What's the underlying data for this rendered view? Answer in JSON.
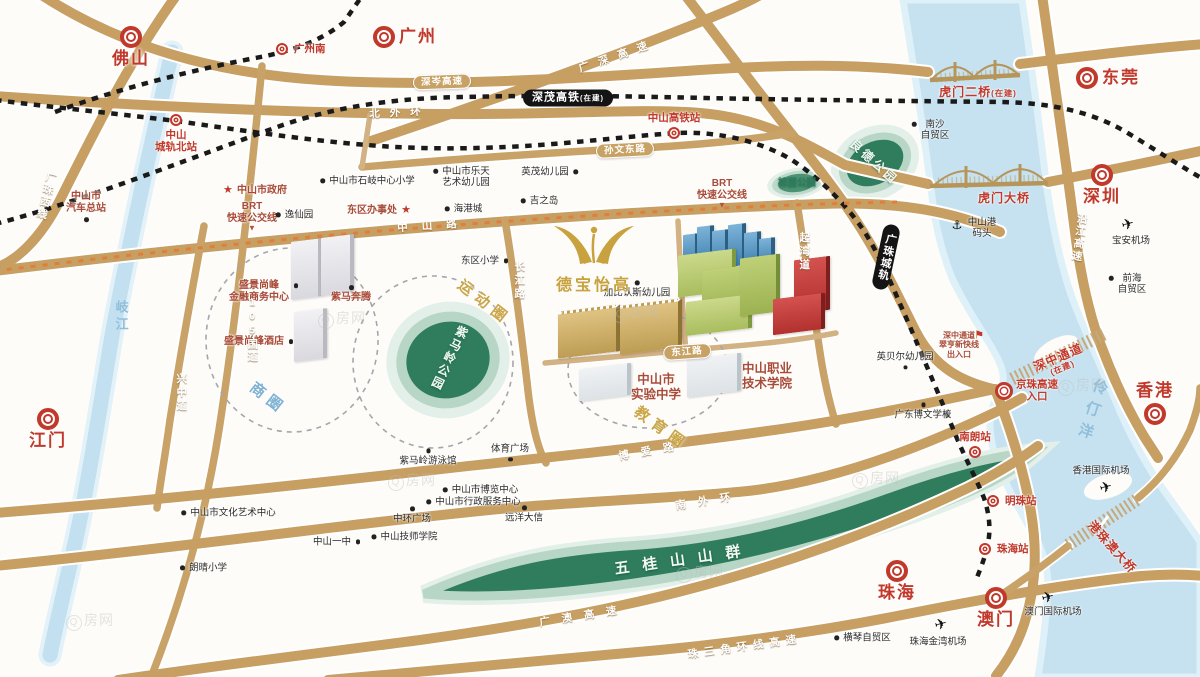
{
  "meta": {
    "watermark": "Q房网"
  },
  "brand": {
    "name": "德宝怡高"
  },
  "colors": {
    "accent_red": "#c0392b",
    "poi_red": "#a84b38",
    "road_tan": "#c79f63",
    "rail_black": "#1a1a1a",
    "park_green": "#2f7d5c",
    "water_blue": "#c6e2f0",
    "gold": "#c8a23e",
    "brt_orange": "#e07f3a"
  },
  "features": [
    {
      "t": "city",
      "name": "city-foshan",
      "text": "佛山",
      "x": 131,
      "y": 37,
      "lp": "b"
    },
    {
      "t": "city",
      "name": "city-guangzhou",
      "text": "广州",
      "x": 384,
      "y": 37,
      "lp": "r"
    },
    {
      "t": "city",
      "name": "city-dongguan",
      "text": "东莞",
      "x": 1087,
      "y": 78,
      "lp": "r"
    },
    {
      "t": "city",
      "name": "city-shenzhen",
      "text": "深圳",
      "x": 1102,
      "y": 175,
      "lp": "b"
    },
    {
      "t": "city",
      "name": "city-hongkong",
      "text": "香港",
      "x": 1155,
      "y": 414,
      "lp": "a"
    },
    {
      "t": "city",
      "name": "city-jiangmen",
      "text": "江门",
      "x": 48,
      "y": 419,
      "lp": "b"
    },
    {
      "t": "city",
      "name": "city-zhuhai",
      "text": "珠海",
      "x": 897,
      "y": 571,
      "lp": "b"
    },
    {
      "t": "city",
      "name": "city-macau",
      "text": "澳门",
      "x": 996,
      "y": 598,
      "lp": "b"
    },
    {
      "t": "sta",
      "name": "station-guangzhounan",
      "text": "广州南",
      "x": 282,
      "y": 49,
      "lp": "r"
    },
    {
      "t": "sta",
      "name": "station-zhongshanbei",
      "lines": [
        "中山",
        "城轨北站"
      ],
      "x": 176,
      "y": 120,
      "lp": "b"
    },
    {
      "t": "sta",
      "name": "station-zhongshan-hsr",
      "text": "中山高铁站",
      "x": 674,
      "y": 133,
      "lp": "a",
      "size": 12
    },
    {
      "t": "sta",
      "name": "station-nanlang",
      "text": "南朗站",
      "x": 975,
      "y": 452,
      "lp": "a"
    },
    {
      "t": "sta",
      "name": "station-mingzhu",
      "text": "明珠站",
      "x": 993,
      "y": 501,
      "lp": "r"
    },
    {
      "t": "sta",
      "name": "station-zhuhai",
      "text": "珠海站",
      "x": 985,
      "y": 549,
      "lp": "r"
    },
    {
      "t": "sta",
      "name": "jingzhu-expressway-entrance",
      "lines": [
        "京珠高速",
        "入口"
      ],
      "x": 1004,
      "y": 391,
      "lp": "r",
      "size": 12,
      "cls": "big"
    },
    {
      "t": "poir",
      "name": "poi-city-hall",
      "text": "中山市政府",
      "x": 262,
      "y": 191,
      "star": "l"
    },
    {
      "t": "poir",
      "name": "poi-dongqu-office",
      "text": "东区办事处",
      "x": 372,
      "y": 211,
      "star": "r"
    },
    {
      "t": "poir",
      "name": "brt-label-west",
      "lines": [
        "BRT",
        "快速公交线"
      ],
      "x": 252,
      "y": 213
    },
    {
      "t": "poir",
      "name": "brt-label-east",
      "lines": [
        "BRT",
        "快速公交线"
      ],
      "x": 722,
      "y": 190
    },
    {
      "t": "poir",
      "name": "poi-bus-terminal",
      "lines": [
        "中山市",
        "汽车总站"
      ],
      "x": 86,
      "y": 203,
      "dot": "b"
    },
    {
      "t": "poir",
      "name": "poi-shengjing-center",
      "lines": [
        "盛景尚峰",
        "金融商务中心"
      ],
      "x": 259,
      "y": 292,
      "dot": "r"
    },
    {
      "t": "poir",
      "name": "poi-shengjing-hotel",
      "text": "盛景尚峰酒店",
      "x": 254,
      "y": 342,
      "dot": "r"
    },
    {
      "t": "poir",
      "name": "poi-zima-benteng",
      "text": "紫马奔腾",
      "x": 351,
      "y": 298,
      "dot": "a"
    },
    {
      "t": "poir",
      "name": "poi-experimental-school",
      "lines": [
        "中山市",
        "实验中学"
      ],
      "x": 656,
      "y": 387,
      "size": 12.5
    },
    {
      "t": "poir",
      "name": "poi-polytechnic",
      "lines": [
        "中山职业",
        "技术学院"
      ],
      "x": 767,
      "y": 376,
      "size": 12.5
    },
    {
      "t": "poir",
      "name": "shenzhong-entrance-note",
      "lines": [
        "深中通道",
        "翠亨新快线",
        "出入口"
      ],
      "x": 959,
      "y": 345,
      "size": 8
    },
    {
      "t": "br",
      "name": "bridge-humen2-label",
      "text": "虎门二桥",
      "sub": "(在建)",
      "x": 978,
      "y": 92,
      "cls": "inl"
    },
    {
      "t": "br",
      "name": "bridge-humen-label",
      "text": "虎门大桥",
      "x": 1004,
      "y": 198
    },
    {
      "t": "br",
      "name": "bridge-shenzhong-label",
      "lines": [
        "深中通道"
      ],
      "sub": "(在建)",
      "x": 1060,
      "y": 362,
      "rot": -23
    },
    {
      "t": "br",
      "name": "bridge-hzmb-label",
      "text": "港珠澳大桥",
      "x": 1112,
      "y": 547,
      "rot": 48
    },
    {
      "t": "poi",
      "name": "poi-shiqi-primary",
      "text": "中山市石岐中心小学",
      "x": 372,
      "y": 181,
      "dot": "l"
    },
    {
      "t": "poi",
      "name": "poi-letian-kindergarten",
      "lines": [
        "中山市乐天",
        "艺术幼儿园"
      ],
      "x": 466,
      "y": 177,
      "dot": "l"
    },
    {
      "t": "poi",
      "name": "poi-yingmao-kindergarten",
      "text": "英茂幼儿园",
      "x": 545,
      "y": 172,
      "dot": "r"
    },
    {
      "t": "poi",
      "name": "poi-jusco",
      "text": "吉之岛",
      "x": 544,
      "y": 201,
      "dot": "l"
    },
    {
      "t": "poi",
      "name": "poi-harbour-city",
      "text": "海港城",
      "x": 468,
      "y": 209,
      "dot": "l"
    },
    {
      "t": "poi",
      "name": "poi-yixian-garden",
      "text": "逸仙园",
      "x": 299,
      "y": 215,
      "dot": "l"
    },
    {
      "t": "poi",
      "name": "poi-dongqu-primary",
      "text": "东区小学",
      "x": 480,
      "y": 261,
      "dot": "r"
    },
    {
      "t": "poi",
      "name": "poi-jiabirensi-kindergarten",
      "text": "加比认斯幼儿园",
      "x": 637,
      "y": 293,
      "dot": "a"
    },
    {
      "t": "poi",
      "name": "poi-yingbeier-kindergarten",
      "text": "英贝尔幼儿园",
      "x": 905,
      "y": 357,
      "dot": "b"
    },
    {
      "t": "poi",
      "name": "poi-bowen-school",
      "text": "广东博文学校",
      "x": 923,
      "y": 415,
      "dot": "a"
    },
    {
      "t": "poi",
      "name": "poi-nansha-ftz",
      "lines": [
        "南沙",
        "自贸区"
      ],
      "x": 935,
      "y": 130,
      "dot": "l"
    },
    {
      "t": "poi",
      "name": "poi-qianhai-ftz",
      "lines": [
        "前海",
        "自贸区"
      ],
      "x": 1132,
      "y": 284,
      "dot": "l"
    },
    {
      "t": "poi",
      "name": "poi-hengqin-ftz",
      "text": "横琴自贸区",
      "x": 867,
      "y": 638,
      "dot": "l"
    },
    {
      "t": "poi",
      "name": "poi-culture-art-center",
      "text": "中山市文化艺术中心",
      "x": 233,
      "y": 513,
      "dot": "l"
    },
    {
      "t": "poi",
      "name": "poi-langqing-primary",
      "text": "朗晴小学",
      "x": 208,
      "y": 568,
      "dot": "l"
    },
    {
      "t": "poi",
      "name": "poi-no1-middle-school",
      "text": "中山一中",
      "x": 332,
      "y": 542,
      "dot": "r"
    },
    {
      "t": "poi",
      "name": "poi-technician-college",
      "text": "中山技师学院",
      "x": 409,
      "y": 537,
      "dot": "l"
    },
    {
      "t": "poi",
      "name": "poi-zhonghuan-plaza",
      "text": "中环广场",
      "x": 412,
      "y": 519,
      "dot": "a"
    },
    {
      "t": "poi",
      "name": "poi-expo-center",
      "text": "中山市博览中心",
      "x": 485,
      "y": 490,
      "dot": "l"
    },
    {
      "t": "poi",
      "name": "poi-admin-service-center",
      "text": "中山市行政服务中心",
      "x": 478,
      "y": 502,
      "dot": "l"
    },
    {
      "t": "poi",
      "name": "poi-yuanyang-daxin",
      "text": "远洋大信",
      "x": 524,
      "y": 518,
      "dot": "a"
    },
    {
      "t": "poi",
      "name": "poi-sports-plaza",
      "text": "体育广场",
      "x": 510,
      "y": 449,
      "dot": "b"
    },
    {
      "t": "poi",
      "name": "poi-zimaling-natatorium",
      "text": "紫马岭游泳馆",
      "x": 428,
      "y": 461,
      "dot": "a"
    },
    {
      "t": "poi",
      "name": "poi-zhongshan-port",
      "lines": [
        "中山港",
        "码头"
      ],
      "x": 982,
      "y": 228
    },
    {
      "t": "poi",
      "name": "poi-baoan-airport",
      "text": "宝安机场",
      "x": 1131,
      "y": 241
    },
    {
      "t": "poi",
      "name": "poi-hk-airport",
      "text": "香港国际机场",
      "x": 1101,
      "y": 471
    },
    {
      "t": "poi",
      "name": "poi-macau-airport",
      "text": "澳门国际机场",
      "x": 1053,
      "y": 612
    },
    {
      "t": "poi",
      "name": "poi-jinwan-airport",
      "text": "珠海金湾机场",
      "x": 938,
      "y": 642
    },
    {
      "t": "plane",
      "name": "plane-icon-baoan",
      "x": 1128,
      "y": 225,
      "rot": -15
    },
    {
      "t": "plane",
      "name": "plane-icon-hk",
      "x": 1106,
      "y": 488,
      "rot": -15
    },
    {
      "t": "plane",
      "name": "plane-icon-macau",
      "x": 1048,
      "y": 598,
      "rot": -15
    },
    {
      "t": "plane",
      "name": "plane-icon-jinwan",
      "x": 941,
      "y": 625,
      "rot": -15
    },
    {
      "t": "port",
      "name": "ship-icon-zhongshan-port",
      "x": 957,
      "y": 225
    },
    {
      "t": "flag",
      "name": "flag-icon-shenzhong-entrance",
      "x": 979,
      "y": 336
    },
    {
      "t": "tri",
      "name": "brt-pointer-west",
      "x": 252,
      "y": 228
    },
    {
      "t": "tri",
      "name": "brt-pointer-east",
      "x": 722,
      "y": 205
    },
    {
      "t": "rl",
      "name": "road-beiwaihuan",
      "text": "北外环",
      "x": 400,
      "y": 113,
      "rot": -3,
      "sp": 10
    },
    {
      "t": "rl",
      "name": "road-zhongshanlu",
      "text": "中山路",
      "x": 434,
      "y": 226,
      "rot": -4,
      "sp": 14
    },
    {
      "t": "rl",
      "name": "road-boailu",
      "text": "博爱路",
      "x": 652,
      "y": 451,
      "rot": -10,
      "sp": 12
    },
    {
      "t": "rl",
      "name": "road-nanwaihuan",
      "text": "南外环",
      "x": 709,
      "y": 501,
      "rot": -9,
      "sp": 12
    },
    {
      "t": "rl",
      "name": "road-guang-ao-expwy",
      "text": "广澳高速",
      "x": 584,
      "y": 616,
      "rot": -9,
      "sp": 12
    },
    {
      "t": "rl",
      "name": "road-prd-ring-expwy",
      "text": "珠三角环线高速",
      "x": 745,
      "y": 647,
      "rot": -8,
      "sp": 6
    },
    {
      "t": "rl",
      "name": "road-guangshen-expwy",
      "text": "广深高速",
      "x": 618,
      "y": 56,
      "rot": -19,
      "sp": 10
    },
    {
      "t": "rl",
      "name": "road-changjianglu",
      "text": "长江路",
      "x": 519,
      "y": 281,
      "vert": 1,
      "sp": 3
    },
    {
      "t": "rl",
      "name": "road-qiwandao",
      "text": "起湾道",
      "x": 804,
      "y": 252,
      "vert": 1,
      "sp": 3
    },
    {
      "t": "rl",
      "name": "road-xingzhongdao",
      "text": "兴中道",
      "x": 181,
      "y": 393,
      "vert": 1,
      "sp": 3
    },
    {
      "t": "rl",
      "name": "road-g105",
      "text": "105国道",
      "x": 252,
      "y": 330,
      "vert": 1,
      "sp": 2
    },
    {
      "t": "rl",
      "name": "road-guangzhu-west-line",
      "text": "广珠西线",
      "x": 46,
      "y": 196,
      "vert": 1,
      "rot": 14,
      "sp": 2
    },
    {
      "t": "rl",
      "name": "road-yanjiang-expwy",
      "text": "沿江高速",
      "x": 1079,
      "y": 238,
      "vert": 1,
      "rot": 8,
      "sp": 2
    },
    {
      "t": "pill",
      "name": "road-shencen-expwy",
      "text": "深岑高速",
      "x": 442,
      "y": 82,
      "rot": -2
    },
    {
      "t": "pill",
      "name": "road-sunwen-east",
      "text": "孙文东路",
      "x": 625,
      "y": 150,
      "rot": -3
    },
    {
      "t": "pill",
      "name": "road-dongjianglu",
      "text": "东江路",
      "x": 687,
      "y": 352,
      "rot": -4
    },
    {
      "t": "rp",
      "name": "rail-shenmao-hsr",
      "text": "深茂高铁",
      "sub": "(在建)",
      "x": 568,
      "y": 98,
      "cls": "inl"
    },
    {
      "t": "rp",
      "name": "rail-guangzhu-icr",
      "text": "广珠城轨",
      "x": 886,
      "y": 257,
      "vert": 1,
      "rot": 12
    },
    {
      "t": "zone",
      "name": "zone-business",
      "text": "商圈",
      "x": 268,
      "y": 399,
      "rot": 38,
      "color": "#79aed2",
      "sp": 6
    },
    {
      "t": "zone",
      "name": "zone-sports",
      "text": "运动圈",
      "x": 484,
      "y": 303,
      "rot": 38,
      "color": "#c9a23f",
      "sp": 6
    },
    {
      "t": "zone",
      "name": "zone-education",
      "text": "教育圈",
      "x": 661,
      "y": 429,
      "rot": 36,
      "color": "#c9a23f",
      "sp": 6
    },
    {
      "t": "wl",
      "name": "water-qijiang",
      "text": "岐江",
      "x": 121,
      "y": 317,
      "vert": 1
    },
    {
      "t": "wl",
      "name": "water-lingdingyang",
      "text": "伶仃洋",
      "x": 1091,
      "y": 412,
      "vert": 1,
      "rot": 18,
      "sp": 8,
      "size": 15
    },
    {
      "t": "pk",
      "name": "park-liangde",
      "text": "良德公园",
      "x": 874,
      "y": 162,
      "rot": 42,
      "sp": 3
    },
    {
      "t": "pk",
      "name": "park-zimaling",
      "text": "紫马岭公园",
      "x": 449,
      "y": 358,
      "vert": 1,
      "rot": 25,
      "sp": 2
    },
    {
      "t": "pk",
      "name": "park-zongyin",
      "text": "棕茵公园",
      "x": 797,
      "y": 183,
      "size": 9.5,
      "color": "#2f7d5f"
    },
    {
      "t": "pk",
      "name": "wuguishan-mountains",
      "text": "五桂山山群",
      "x": 684,
      "y": 560,
      "rot": -8,
      "sp": 13,
      "size": 15
    }
  ],
  "buildings": [
    {
      "x": 683,
      "y": 234,
      "w": 12,
      "h": 32,
      "c": "blue"
    },
    {
      "x": 697,
      "y": 226,
      "w": 13,
      "h": 40,
      "c": "blue"
    },
    {
      "x": 712,
      "y": 230,
      "w": 13,
      "h": 36,
      "c": "blue"
    },
    {
      "x": 728,
      "y": 224,
      "w": 14,
      "h": 42,
      "c": "blue"
    },
    {
      "x": 744,
      "y": 232,
      "w": 13,
      "h": 34,
      "c": "blue"
    },
    {
      "x": 759,
      "y": 238,
      "w": 12,
      "h": 28,
      "c": "blue"
    },
    {
      "x": 678,
      "y": 252,
      "w": 54,
      "h": 42,
      "c": "green"
    },
    {
      "x": 702,
      "y": 266,
      "w": 72,
      "h": 48,
      "c": "green2"
    },
    {
      "x": 686,
      "y": 298,
      "w": 62,
      "h": 34,
      "c": "green"
    },
    {
      "x": 740,
      "y": 256,
      "w": 36,
      "h": 58,
      "c": "green2"
    },
    {
      "x": 794,
      "y": 258,
      "w": 32,
      "h": 54,
      "c": "red"
    },
    {
      "x": 773,
      "y": 296,
      "w": 48,
      "h": 36,
      "c": "red"
    },
    {
      "x": 558,
      "y": 308,
      "w": 58,
      "h": 44,
      "c": "gold"
    },
    {
      "x": 620,
      "y": 302,
      "w": 58,
      "h": 46,
      "c": "gold"
    },
    {
      "x": 291,
      "y": 240,
      "w": 27,
      "h": 58,
      "c": "gray"
    },
    {
      "x": 321,
      "y": 236,
      "w": 29,
      "h": 58,
      "c": "gray"
    },
    {
      "x": 294,
      "y": 310,
      "w": 29,
      "h": 50,
      "c": "gray"
    },
    {
      "x": 579,
      "y": 366,
      "w": 48,
      "h": 32,
      "c": "school"
    },
    {
      "x": 687,
      "y": 356,
      "w": 50,
      "h": 38,
      "c": "school"
    }
  ],
  "watermarks": [
    {
      "x": 318,
      "y": 308
    },
    {
      "x": 612,
      "y": 302
    },
    {
      "x": 388,
      "y": 470
    },
    {
      "x": 852,
      "y": 468
    },
    {
      "x": 66,
      "y": 610
    },
    {
      "x": 1058,
      "y": 375
    },
    {
      "x": 676,
      "y": 562
    }
  ]
}
